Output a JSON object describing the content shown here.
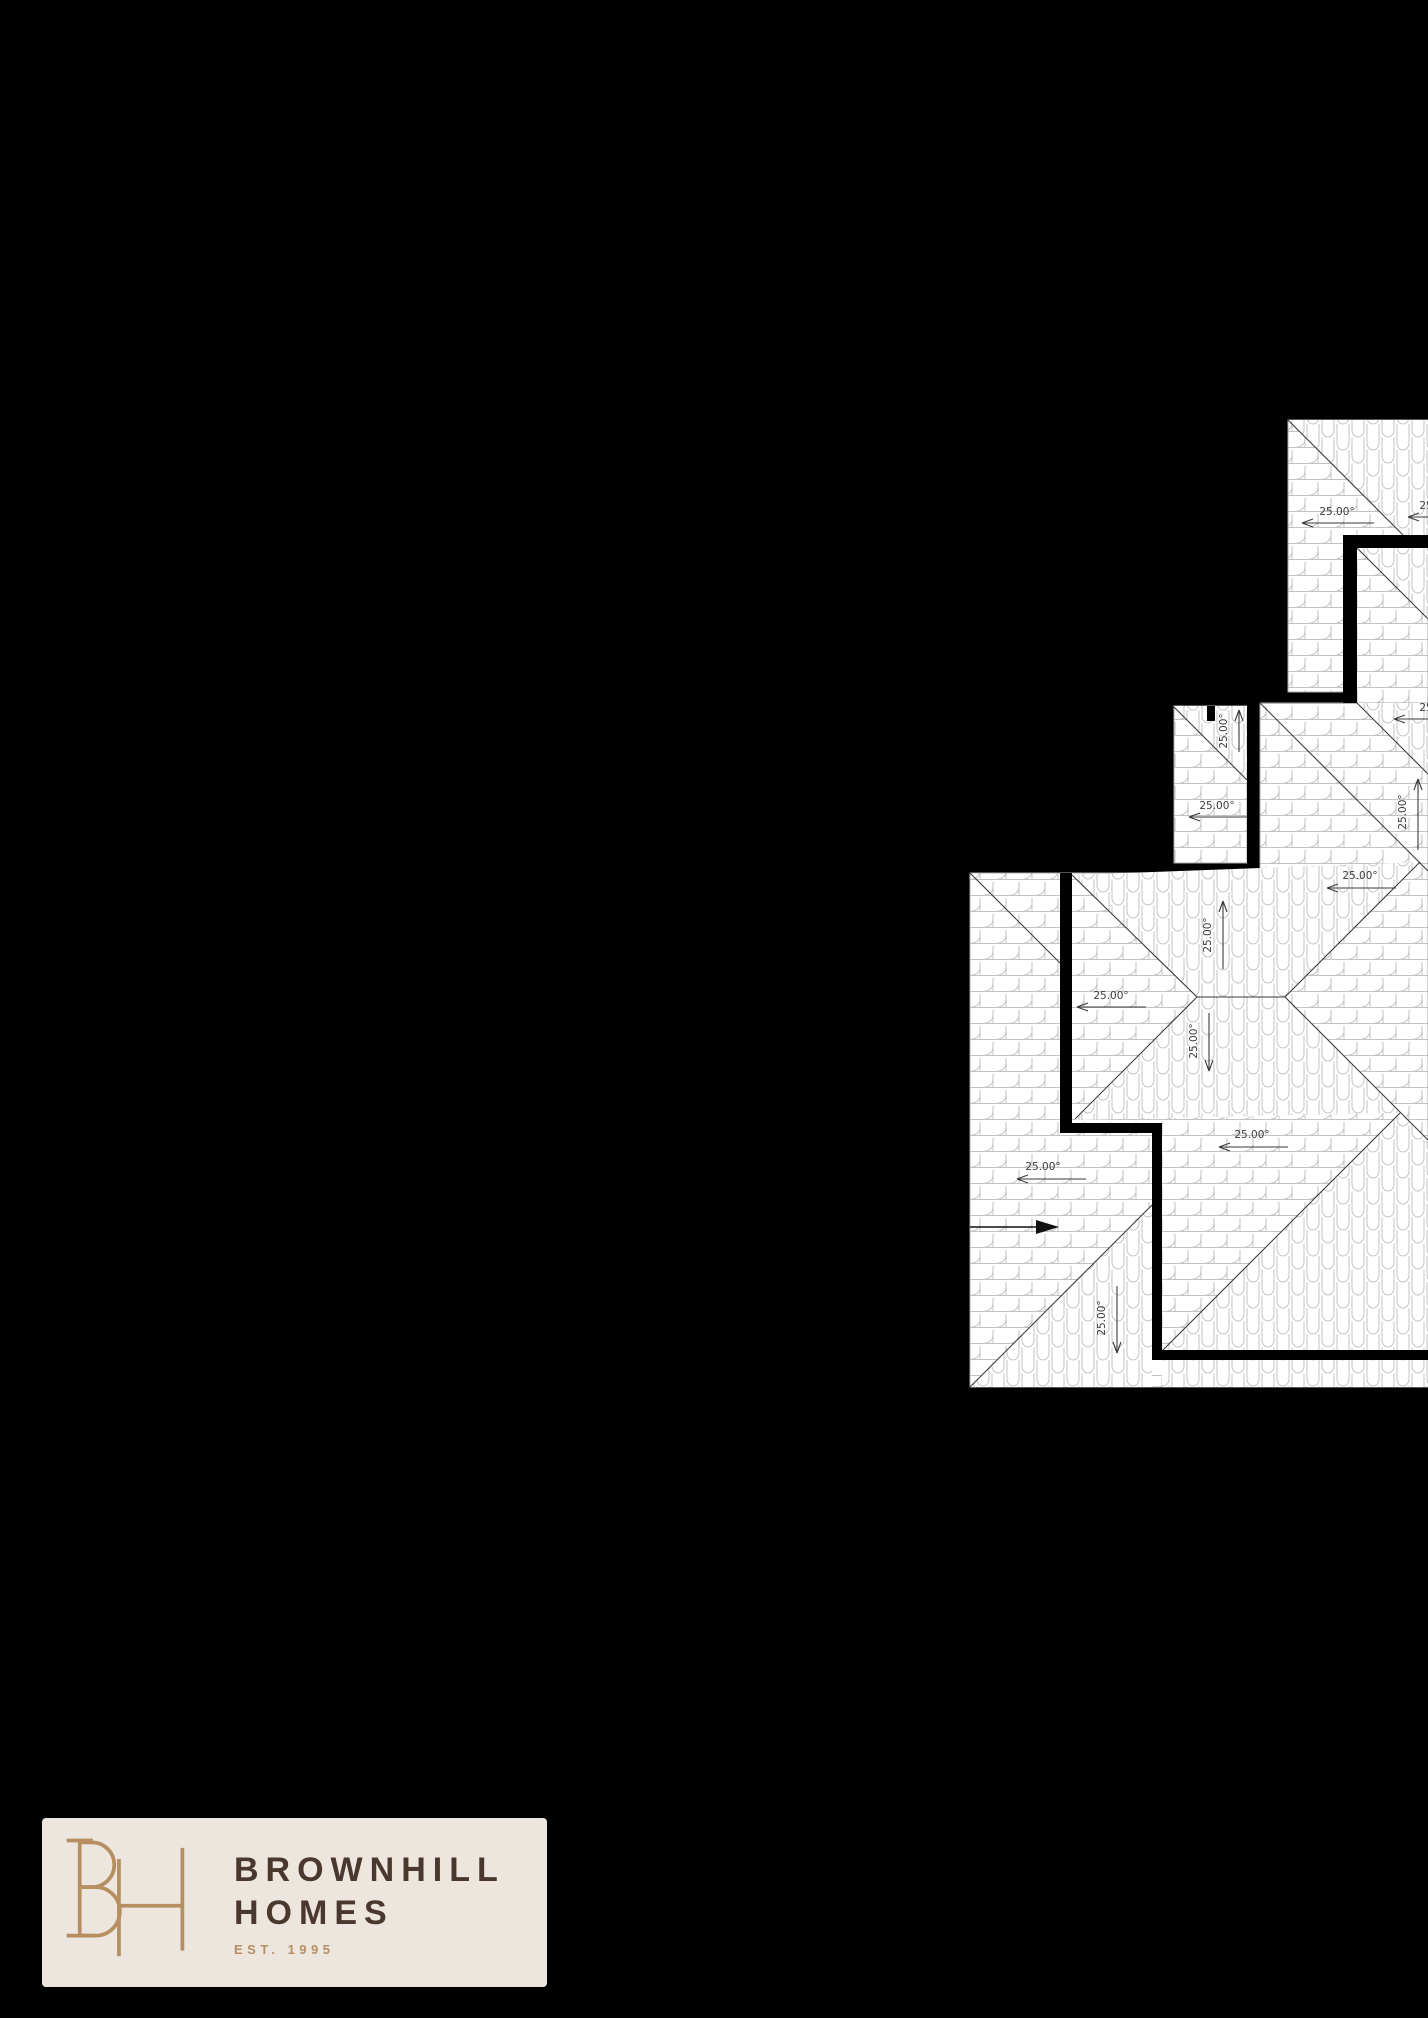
{
  "page": {
    "width": 1428,
    "height": 2018,
    "background_color": "#000000"
  },
  "roof_plan": {
    "colors": {
      "paper": "#ffffff",
      "tile_line": "#c3c3c3",
      "draw_line": "#3b3b3b",
      "wall": "#000000",
      "edge_line": "#aaaaaa"
    },
    "pitch_labels": [
      {
        "text": "25.00°",
        "x": 1337,
        "y": 515,
        "rotation": 0,
        "arrow": {
          "x1": 1302,
          "y1": 523,
          "x2": 1374,
          "y2": 523,
          "head": "left"
        }
      },
      {
        "text": "25.00°",
        "x": 1437,
        "y": 509,
        "rotation": 0,
        "arrow": {
          "x1": 1408,
          "y1": 517,
          "x2": 1444,
          "y2": 517,
          "head": "left"
        }
      },
      {
        "text": "25.00°",
        "x": 1227,
        "y": 731,
        "rotation": -90,
        "arrow": {
          "x1": 1239,
          "y1": 710,
          "x2": 1239,
          "y2": 752,
          "head": "up"
        }
      },
      {
        "text": "25.00°",
        "x": 1217,
        "y": 809,
        "rotation": 0,
        "arrow": {
          "x1": 1189,
          "y1": 817,
          "x2": 1247,
          "y2": 817,
          "head": "left"
        }
      },
      {
        "text": "25.00°",
        "x": 1437,
        "y": 711,
        "rotation": 0,
        "arrow": {
          "x1": 1394,
          "y1": 719,
          "x2": 1444,
          "y2": 719,
          "head": "left"
        }
      },
      {
        "text": "25.00°",
        "x": 1406,
        "y": 812,
        "rotation": -90,
        "arrow": {
          "x1": 1418,
          "y1": 779,
          "x2": 1418,
          "y2": 850,
          "head": "up"
        }
      },
      {
        "text": "25.00°",
        "x": 1360,
        "y": 879,
        "rotation": 0,
        "arrow": {
          "x1": 1327,
          "y1": 888,
          "x2": 1396,
          "y2": 888,
          "head": "left"
        }
      },
      {
        "text": "25.00°",
        "x": 1211,
        "y": 935,
        "rotation": -90,
        "arrow": {
          "x1": 1223,
          "y1": 901,
          "x2": 1223,
          "y2": 969,
          "head": "up"
        }
      },
      {
        "text": "25.00°",
        "x": 1111,
        "y": 999,
        "rotation": 0,
        "arrow": {
          "x1": 1077,
          "y1": 1007,
          "x2": 1146,
          "y2": 1007,
          "head": "left"
        }
      },
      {
        "text": "25.00°",
        "x": 1197,
        "y": 1041,
        "rotation": -90,
        "arrow": {
          "x1": 1209,
          "y1": 1071,
          "x2": 1209,
          "y2": 1013,
          "head": "down"
        }
      },
      {
        "text": "25.00°",
        "x": 1252,
        "y": 1138,
        "rotation": 0,
        "arrow": {
          "x1": 1219,
          "y1": 1147,
          "x2": 1288,
          "y2": 1147,
          "head": "left"
        }
      },
      {
        "text": "25.00°",
        "x": 1043,
        "y": 1170,
        "rotation": 0,
        "arrow": {
          "x1": 1017,
          "y1": 1179,
          "x2": 1086,
          "y2": 1179,
          "head": "left"
        }
      },
      {
        "text": "25.00°",
        "x": 1105,
        "y": 1318,
        "rotation": -90,
        "arrow": {
          "x1": 1117,
          "y1": 1353,
          "x2": 1117,
          "y2": 1286,
          "head": "down"
        }
      }
    ],
    "north_arrow": {
      "x1": 970,
      "y1": 1227,
      "x2": 1036,
      "y2": 1227,
      "head_points": "1036,1220 1059,1227 1036,1234"
    }
  },
  "logo": {
    "monogram": "BH",
    "name_line1": "BROWNHILL",
    "name_line2": "HOMES",
    "tagline": "EST. 1995",
    "colors": {
      "background": "#ECE6DF",
      "gold": "#B68E60",
      "brown": "#4A382E"
    }
  }
}
